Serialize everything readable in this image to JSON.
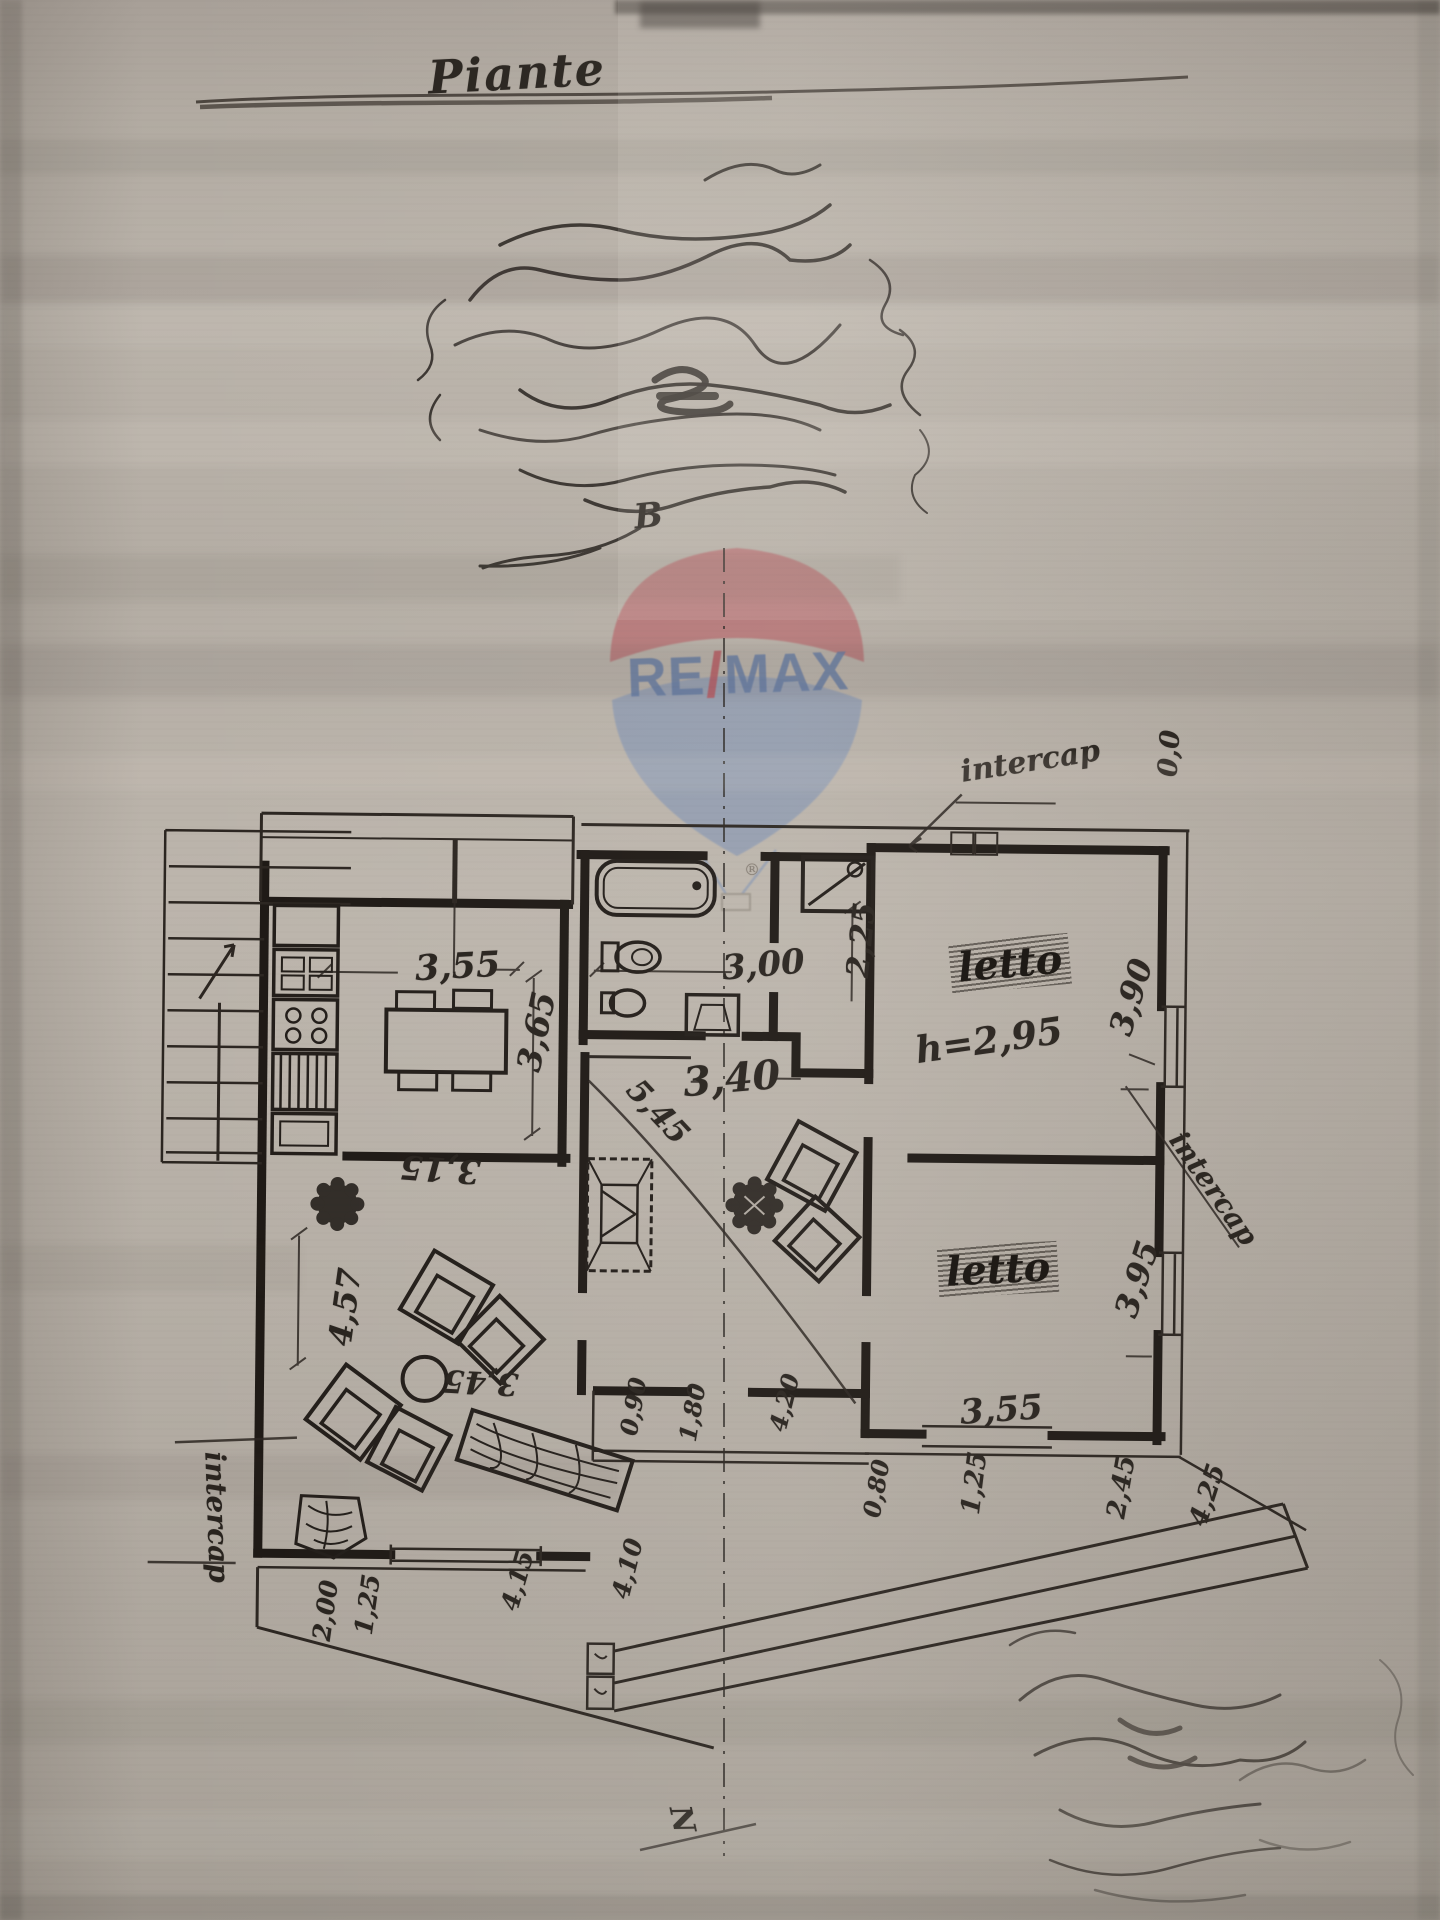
{
  "document": {
    "title": "Piante"
  },
  "watermark": {
    "re": "RE",
    "slash": "/",
    "max": "MAX",
    "registered": "®",
    "balloon_red": "#b55a60",
    "balloon_blue": "#7f92b3",
    "text_blue": "#5f77a1"
  },
  "plan": {
    "section_label": "B",
    "north_label": "N",
    "annotations": {
      "intercap_top_right": "intercap",
      "intercap_left": "intercap",
      "intercap_right": "intercap",
      "origin": "0,0"
    },
    "rooms": {
      "bedroom_top": "letto",
      "bedroom_bottom": "letto",
      "bedroom_height": "h=2,95"
    },
    "dimensions": {
      "kitchen_width": "3,55",
      "kitchen_depth": "3,65",
      "kitchen_bottom": "3,15",
      "bath_width": "3,00",
      "shower_depth": "2,25",
      "hall_width": "3,40",
      "hall_diagonal": "5,45",
      "bedroom_top_depth": "3,90",
      "bedroom_bottom_depth": "3,95",
      "bedroom_bottom_width": "3,55",
      "living_depth": "4,57",
      "living_width": "3,45",
      "window_1": "1,25",
      "window_2": "2,45",
      "balcony_right": "4,25",
      "loggia_1": "0,90",
      "loggia_2": "1,80",
      "loggia_3": "4,20",
      "loggia_4": "0,80",
      "terrace_1": "4,15",
      "terrace_2": "4,10",
      "terrace_3": "2,00",
      "terrace_4": "1,25"
    }
  }
}
